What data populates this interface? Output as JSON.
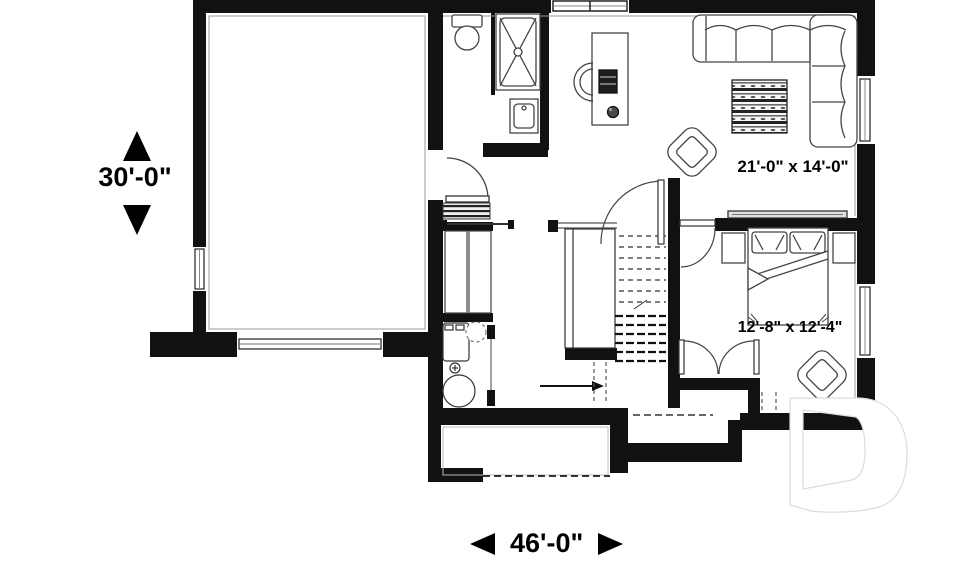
{
  "document": {
    "type": "basement-floor-plan",
    "background": "#ffffff"
  },
  "dimensions": {
    "height": {
      "label": "30'-0\""
    },
    "width": {
      "label": "46'-0\""
    }
  },
  "rooms": [
    {
      "name": "family-room",
      "size_label": "21'-0\" x 14'-0\""
    },
    {
      "name": "bedroom",
      "size_label": "12'-8\" x 12'-4\""
    }
  ],
  "colors": {
    "walls": "#111111",
    "furniture_lines": "#444444",
    "dimension_text": "#000000",
    "logo_outline": "#dcdcdc"
  },
  "icons": [
    "sectional-sofa",
    "ottoman",
    "armchair",
    "desk",
    "desk-chair",
    "computer",
    "plant",
    "tv-console",
    "bed",
    "pillow",
    "nightstand",
    "wardrobe-doors",
    "toilet",
    "shower",
    "vanity-sink",
    "washer",
    "water-heater",
    "floor-drain",
    "staircase",
    "entry-steps",
    "garage-door",
    "window",
    "door-swing",
    "up-arrow",
    "down-arrow",
    "left-arrow",
    "right-arrow",
    "d-logo-watermark"
  ]
}
